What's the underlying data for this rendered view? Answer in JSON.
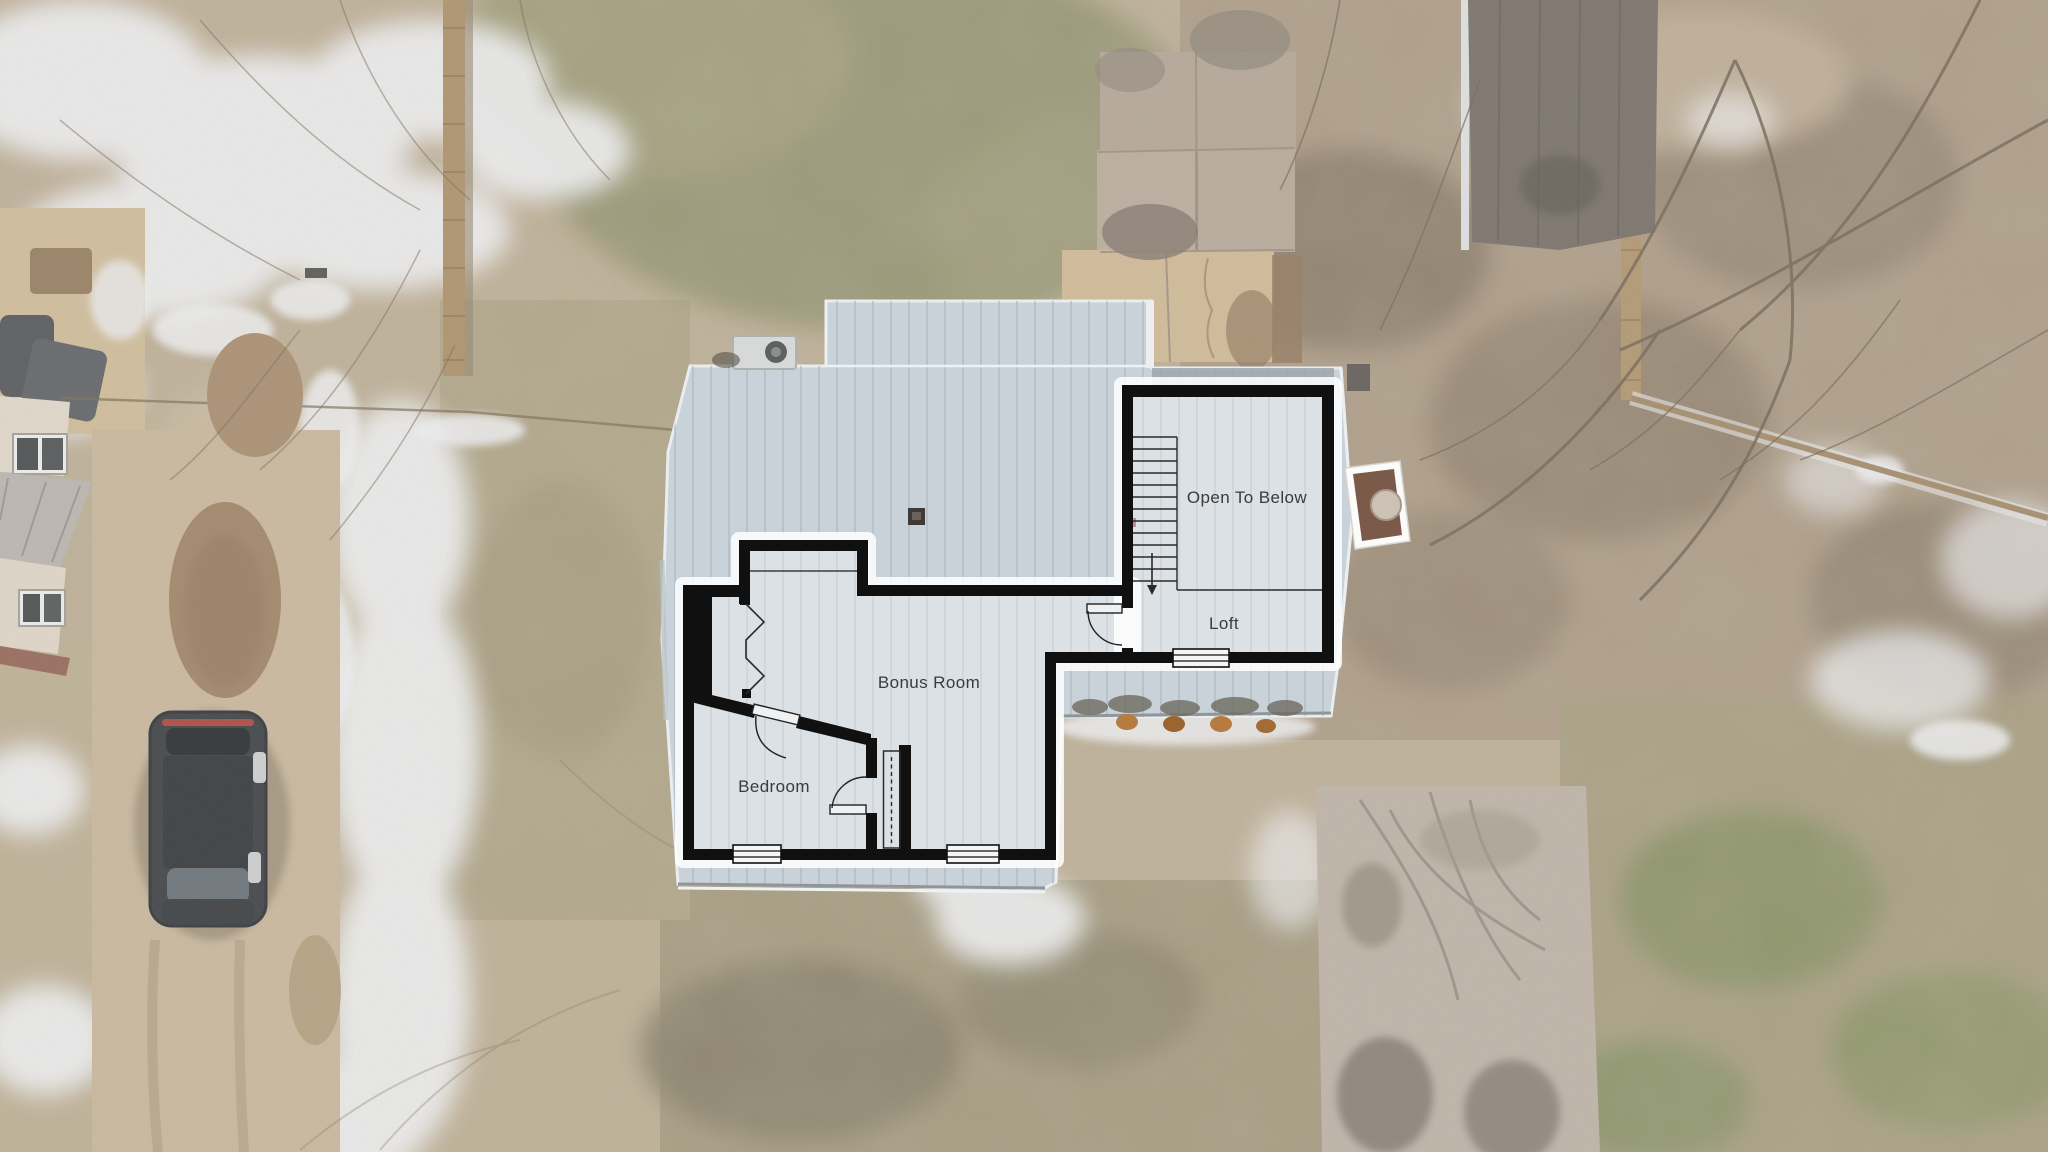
{
  "scene": {
    "floor_plan": {
      "rooms": [
        {
          "id": "open-to-below",
          "label": "Open To Below"
        },
        {
          "id": "loft",
          "label": "Loft"
        },
        {
          "id": "bonus-room",
          "label": "Bonus Room"
        },
        {
          "id": "bedroom",
          "label": "Bedroom"
        }
      ],
      "features": [
        "staircase",
        "stair-down-arrow",
        "door-swings",
        "windows",
        "closet-dashed-line",
        "zigzag-knee-wall"
      ],
      "wall_color": "#101010",
      "floor_fill": "rgba(255,255,255,0.33)",
      "label_color": "#3b3b3b"
    },
    "photo": {
      "roof_color": "#c9d2d8",
      "roof_seam_color": "#adb7bf",
      "snow_color": "#e9eaec",
      "ground_tan": "#b7a68c",
      "grass_olive": "#8c8a66",
      "leaf_brown": "#a4917a",
      "concrete": "#b6ab9e",
      "objects": [
        "house-roof",
        "chimney",
        "ac-unit",
        "roof-vent",
        "car",
        "neighbor-house",
        "patio-furniture",
        "wood-fences",
        "paver-patio",
        "concrete-driveway",
        "tree-branches",
        "snow-patches",
        "shrubs"
      ]
    }
  }
}
